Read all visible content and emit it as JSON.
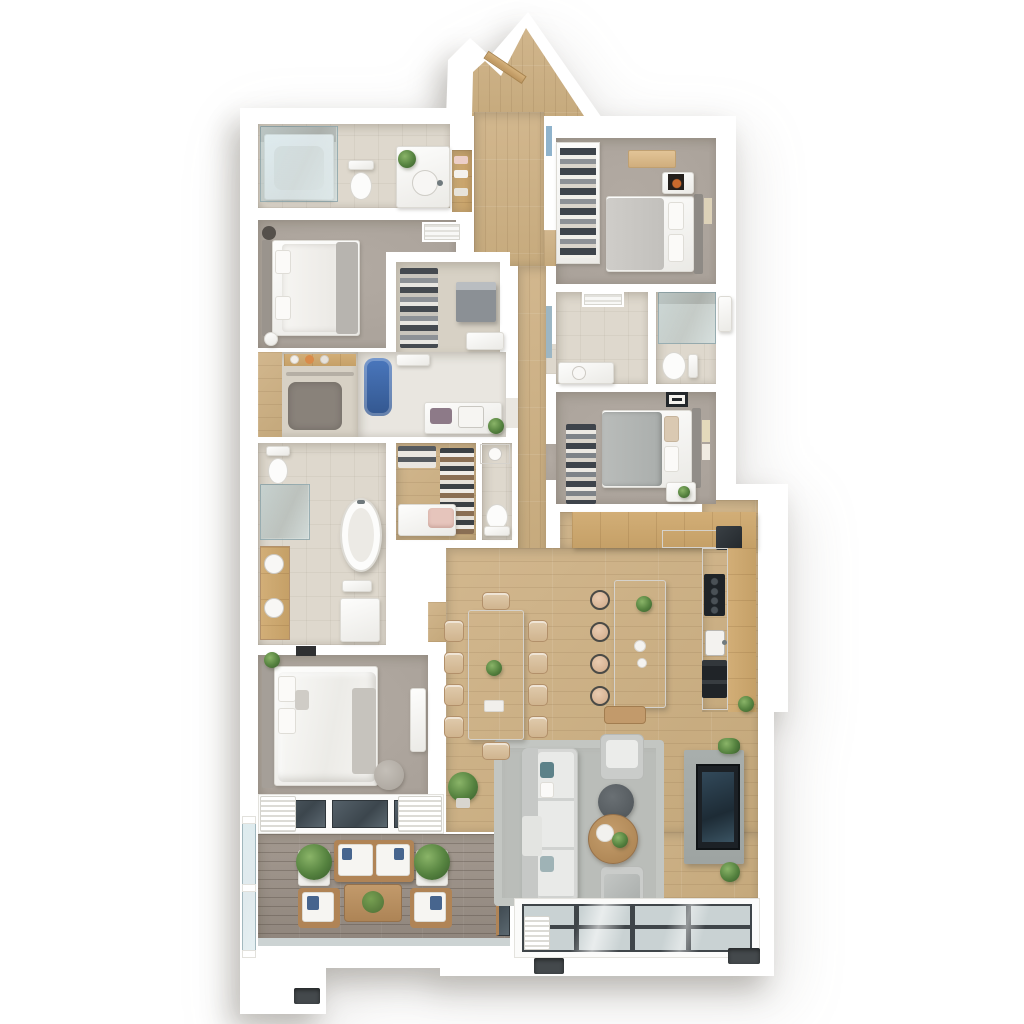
{
  "title": "3D Apartment Floor Plan",
  "palette": {
    "wall": "#ffffff",
    "wood": "#d2b78e",
    "carpet": "#a59d95",
    "tile": "#ded8cd",
    "closet": "#d7d1c5",
    "deck": "#8f857c",
    "oak": "#d2ae77",
    "marble": "#eceae5",
    "rug": "#babdb9",
    "sofa": "#d6d7d5",
    "concrete": "#9ea4a2",
    "tv": "#1c2126",
    "glass": "#c9d2d3",
    "frame": "#3f4549",
    "plant": "#55823f",
    "blush": "#e6c5bc",
    "denim": "#47658e",
    "steel": "#90959a"
  },
  "rooms": {
    "entry_hall": "Entry Hall",
    "hallway": "Hallway",
    "bathroom_main": "Main Bathroom",
    "linen_closet": "Linen Closet",
    "bedroom_2": "Bedroom 2",
    "walk_in_closet": "Walk-in Closet",
    "nursery_closet": "Nursery Closet",
    "utility_room": "Utility Room",
    "master_bathroom": "Master Bathroom",
    "shoe_closet": "Shoe Closet",
    "powder_room": "Powder Room",
    "master_bedroom": "Master Bedroom",
    "balcony": "Balcony",
    "living_room": "Living Room",
    "dining_area": "Dining Area",
    "kitchen": "Kitchen",
    "bedroom_3": "Bedroom 3",
    "bathroom_2": "Bathroom",
    "bedroom_4": "Bedroom 4"
  },
  "furniture": {
    "entry_door": "Entry Door",
    "shower_tub": "Shower Tub",
    "toilet": "Toilet",
    "vanity": "Vanity Sink",
    "bed": "Double Bed",
    "safe": "Storage Cabinet",
    "freestanding_tub": "Freestanding Bathtub",
    "double_vanity": "Double Vanity",
    "shoe_rack": "Shoe Rack",
    "bench": "Bench",
    "master_bed": "Master Bed",
    "pouf": "Pouf",
    "balcony_sofa": "Outdoor Sofa",
    "balcony_chair": "Outdoor Armchair",
    "balcony_table": "Outdoor Coffee Table",
    "sofa": "Sofa",
    "armchair": "Armchair",
    "ottoman": "Ottoman",
    "coffee_table": "Coffee Table",
    "tv": "Television",
    "dining_table": "Dining Table",
    "kitchen_island": "Kitchen Island",
    "fridge": "Refrigerator",
    "cooktop": "Cooktop",
    "kitchen_sink": "Kitchen Sink",
    "oven": "Oven",
    "wardrobe": "Wardrobe"
  }
}
